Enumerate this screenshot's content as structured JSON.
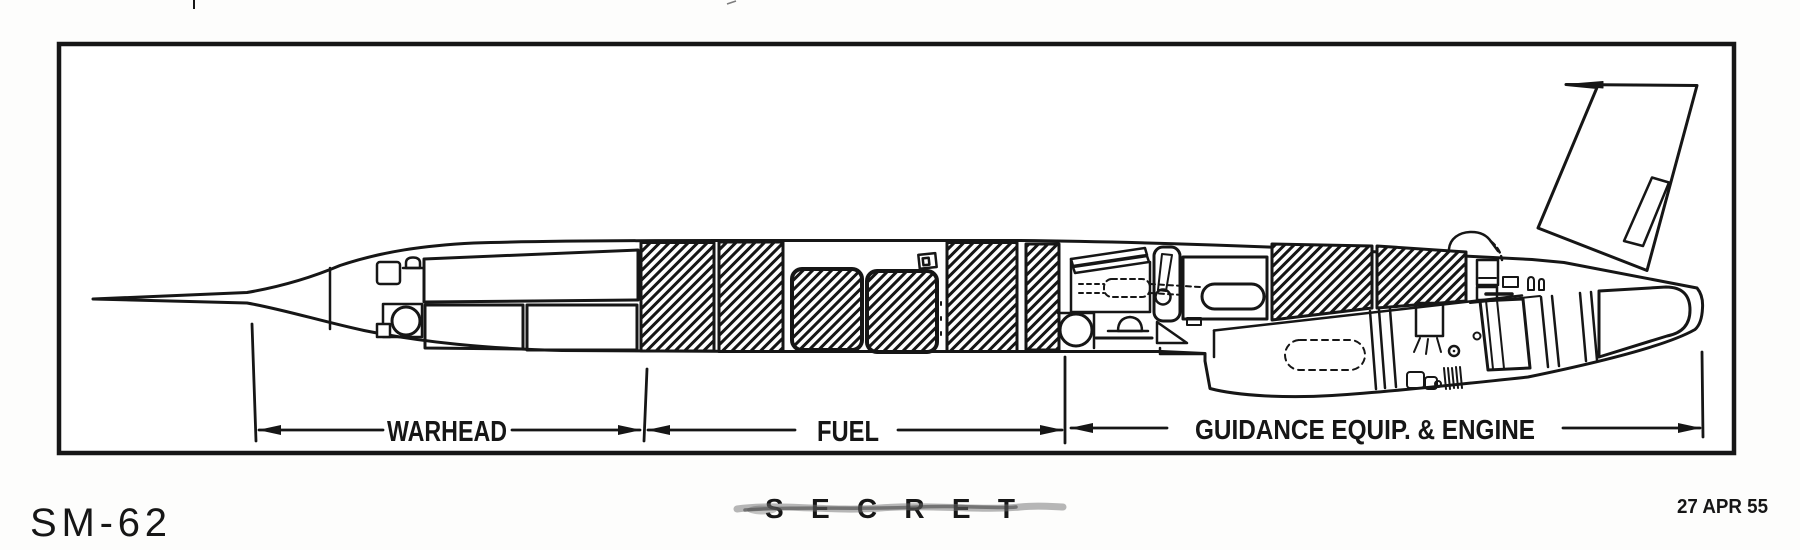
{
  "figure": {
    "designation": "SM-62",
    "date_stamp": "27 APR 55",
    "classification": {
      "text": "SECRET",
      "struck_through": true
    },
    "sections": [
      {
        "label": "WARHEAD"
      },
      {
        "label": "FUEL"
      },
      {
        "label": "GUIDANCE EQUIP. & ENGINE"
      }
    ],
    "line_color": "#161616",
    "paper_color": "#fdfdfc"
  }
}
